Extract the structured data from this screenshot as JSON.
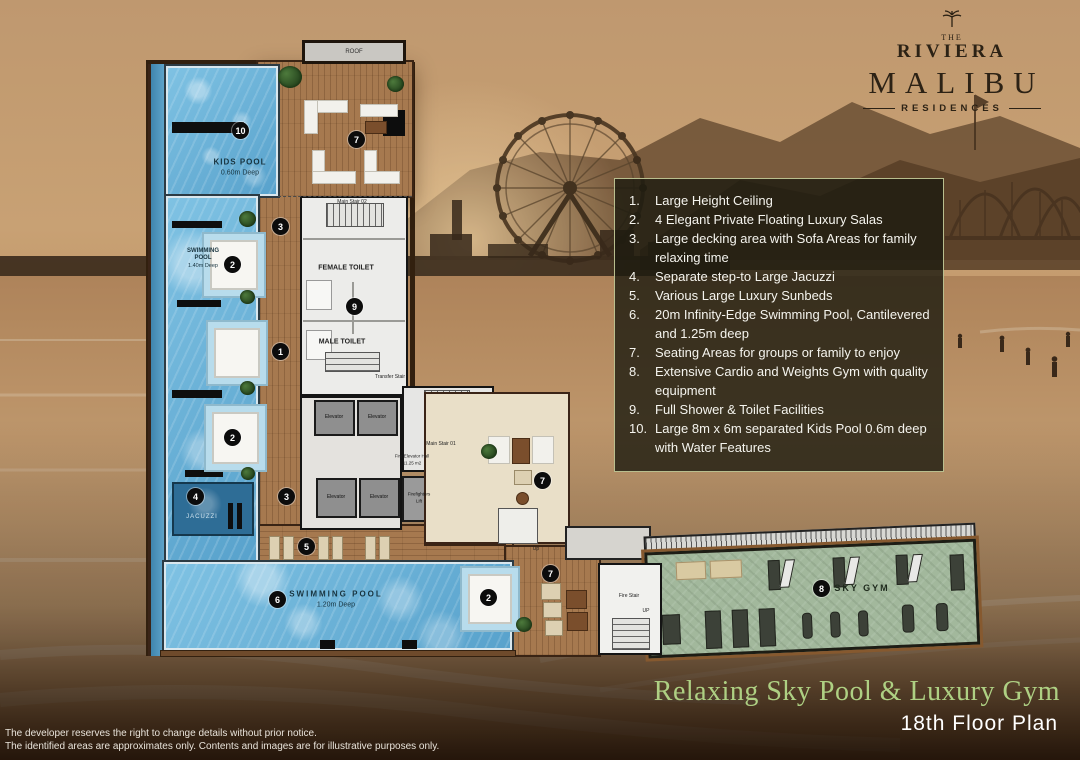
{
  "brand": {
    "the": "THE",
    "riviera": "RIVIERA",
    "malibu": "MALIBU",
    "residences": "RESIDENCES"
  },
  "legend": {
    "items": [
      {
        "num": "1.",
        "text": "Large Height Ceiling"
      },
      {
        "num": "2.",
        "text": "4 Elegant Private Floating Luxury Salas"
      },
      {
        "num": "3.",
        "text": "Large decking area with Sofa Areas for family relaxing time"
      },
      {
        "num": "4.",
        "text": "Separate step-to Large Jacuzzi"
      },
      {
        "num": "5.",
        "text": "Various Large Luxury Sunbeds"
      },
      {
        "num": "6.",
        "text": "20m Infinity-Edge Swimming Pool, Cantilevered and 1.25m deep"
      },
      {
        "num": "7.",
        "text": "Seating Areas for groups or family to enjoy"
      },
      {
        "num": "8.",
        "text": "Extensive Cardio and Weights Gym with quality equipment"
      },
      {
        "num": "9.",
        "text": "Full Shower & Toilet Facilities"
      },
      {
        "num": "10.",
        "text": "Large 8m x 6m separated Kids Pool 0.6m deep with Water Features"
      }
    ]
  },
  "plan": {
    "labels": {
      "roof": "ROOF",
      "kids_pool_name": "KIDS POOL",
      "kids_pool_depth": "0.60m Deep",
      "pool_upper_1": "SWIMMING",
      "pool_upper_2": "POOL",
      "pool_upper_depth": "1.40m Deep",
      "female_toilet": "FEMALE TOILET",
      "male_toilet": "MALE TOILET",
      "main_stair_02": "Main Stair 02",
      "transfer_stair": "Transfer Stair",
      "main_stair_01": "Main Stair 01",
      "fire_elevator_hall": "Fire Elevator Hall",
      "fire_elevator_area": "11.25 m2",
      "elevator": "Elevator",
      "firefighters_1": "Firefighters",
      "firefighters_2": "Lift",
      "jacuzzi": "JACUZZI",
      "pool_lower_name": "SWIMMING POOL",
      "pool_lower_depth": "1.20m Deep",
      "sky_gym": "SKY GYM",
      "fire_stair": "Fire Stair",
      "up": "UP",
      "up_small": "Up"
    },
    "markers": [
      {
        "n": "10"
      },
      {
        "n": "7"
      },
      {
        "n": "3"
      },
      {
        "n": "2"
      },
      {
        "n": "9"
      },
      {
        "n": "1"
      },
      {
        "n": "2"
      },
      {
        "n": "4"
      },
      {
        "n": "3"
      },
      {
        "n": "5"
      },
      {
        "n": "6"
      },
      {
        "n": "2"
      },
      {
        "n": "7"
      },
      {
        "n": "7"
      },
      {
        "n": "8"
      }
    ]
  },
  "footer": {
    "title": "Relaxing Sky Pool & Luxury Gym",
    "subtitle": "18th Floor Plan",
    "disclaimer_1": "The developer reserves the right to change details without prior notice.",
    "disclaimer_2": "The identified areas are approximates only.  Contents and images are for illustrative purposes only."
  },
  "colors": {
    "legend_border": "#b9be8e",
    "title_green": "#aed083",
    "pool_blue": "#6fb3d9",
    "gym_green": "#a2b89c",
    "deck_wood": "#a6794f"
  }
}
